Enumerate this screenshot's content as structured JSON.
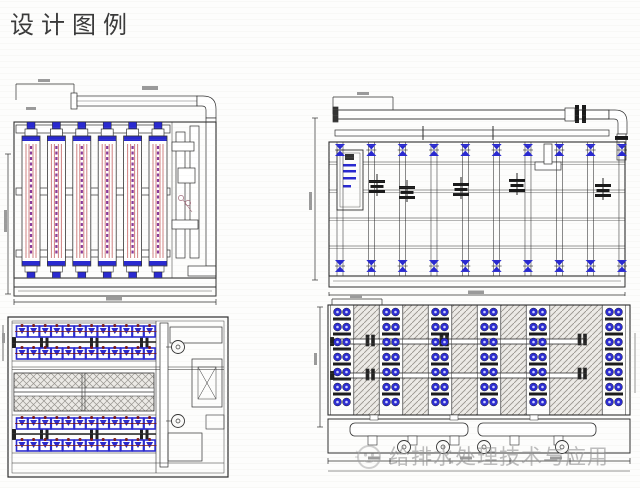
{
  "page": {
    "title": "设计图例",
    "background": "#fdfdfc"
  },
  "watermark": {
    "text": "给排水处理技术与应用",
    "logo": "smiley-face-logo",
    "color": "#a8a8a8"
  },
  "colors": {
    "line": "#2e2e2e",
    "accent_blue": "#2a2ad0",
    "membrane_pink": "#d08080",
    "membrane_purple": "#8a3a9a",
    "dark_red": "#7a1515",
    "hatch_fill": "#eceae6",
    "hatch_line": "#98948e"
  },
  "drawings": {
    "front_elevation": {
      "membrane_columns": 6
    },
    "side_elevation": {
      "bays": 10,
      "valve_stacks": 5
    },
    "plan_left": {
      "bands": 2,
      "rows_per_band": 2,
      "units_per_row": 12,
      "pipe_flanges_per_band": 3
    },
    "plan_right": {
      "module_columns": 6,
      "rows_per_column": 7,
      "hatch_strips": 5,
      "cross_pipes": 2,
      "pumps": 4
    }
  }
}
